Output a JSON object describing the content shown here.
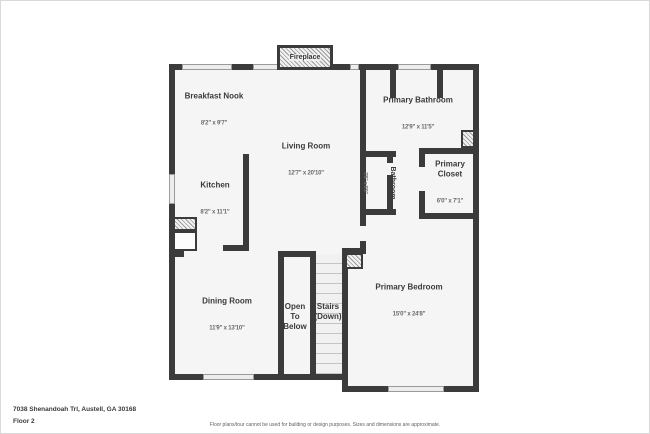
{
  "fireplace": {
    "label": "Fireplace"
  },
  "rooms": {
    "breakfast_nook": {
      "name": "Breakfast Nook",
      "dims": "8'2\" x 9'7\""
    },
    "kitchen": {
      "name": "Kitchen",
      "dims": "8'2\" x 11'1\""
    },
    "living_room": {
      "name": "Living Room",
      "dims": "12'7\" x 20'10\""
    },
    "primary_bathroom": {
      "name": "Primary Bathroom",
      "dims": "12'9\" x 11'5\""
    },
    "bathroom": {
      "name": "Bathroom",
      "dims": "3'6\" x 6'9\""
    },
    "primary_closet": {
      "name": "Primary\nCloset",
      "dims": "6'0\" x 7'1\""
    },
    "dining_room": {
      "name": "Dining Room",
      "dims": "11'9\" x 13'10\""
    },
    "open_to_below": {
      "name": "Open\nTo\nBelow"
    },
    "stairs": {
      "name": "Stairs\n(Down)"
    },
    "primary_bedroom": {
      "name": "Primary Bedroom",
      "dims": "15'0\" x 24'8\""
    }
  },
  "footer": {
    "address": "7038 Shenandoah Trl, Austell, GA 30168",
    "floor_label": "Floor 2",
    "disclaimer": "Floor plans/tour cannot be used for building or design purposes. Sizes and dimensions are approximate."
  },
  "colors": {
    "wall": "#3b3b3b",
    "room_fill": "#f5f5f5",
    "window_fill": "#ededed",
    "background": "#ffffff"
  }
}
